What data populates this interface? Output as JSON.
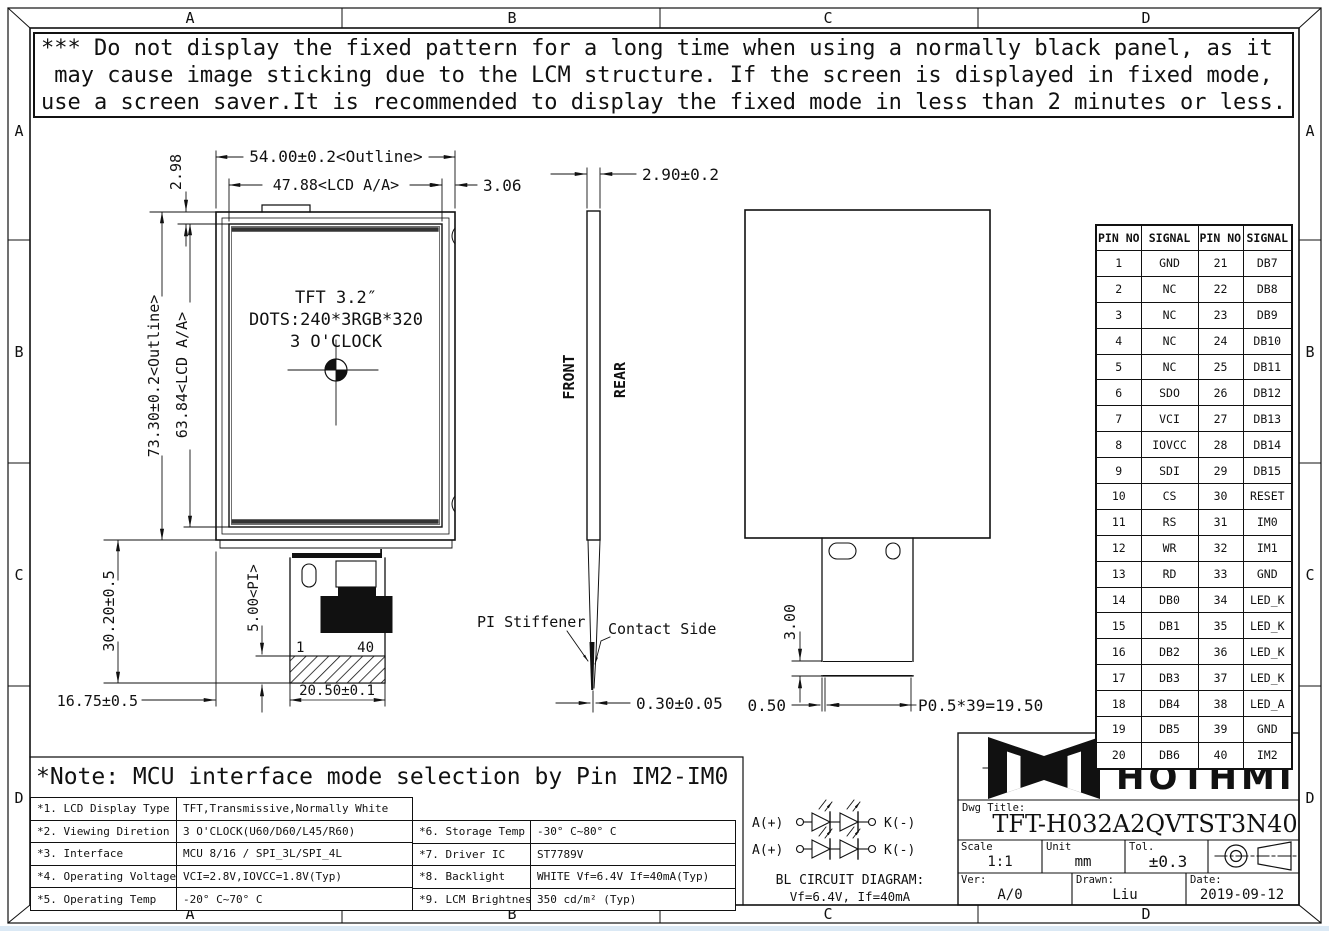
{
  "colors": {
    "line": "#111111",
    "paper": "#ffffff",
    "edge_strip": "#dbe9f5"
  },
  "sheet": {
    "zones": [
      "A",
      "B",
      "C",
      "D"
    ]
  },
  "warning": {
    "line1": "*** Do not display the fixed pattern for a long time when using a normally black panel, as it",
    "line2": "may cause image sticking due to the LCM structure. If the screen is displayed in fixed mode,",
    "line3": "use a screen saver.It is recommended to display the fixed mode in less than 2 minutes or less."
  },
  "front_view": {
    "center_line1": "TFT 3.2″",
    "center_line2": "DOTS:240*3RGB*320",
    "center_line3": "3 O'CLOCK",
    "dims": {
      "outline_w": "54.00±0.2<Outline>",
      "aa_w": "47.88<LCD A/A>",
      "border_r": "3.06",
      "border_t": "2.98",
      "outline_h": "73.30±0.2<Outline>",
      "aa_h": "63.84<LCD A/A>",
      "tail_h": "30.20±0.5",
      "pi_h": "5.00<PI>",
      "tail_offset": "16.75±0.5",
      "tail_w": "20.50±0.1",
      "pin_first": "1",
      "pin_last": "40"
    }
  },
  "side_view": {
    "front_label": "FRONT",
    "rear_label": "REAR",
    "thickness": "2.90±0.2",
    "pi_stiffener": "PI Stiffener",
    "contact_side": "Contact Side",
    "tip_thickness": "0.30±0.05"
  },
  "rear_view": {
    "pad_height": "3.00",
    "edge_gap": "0.50",
    "pitch": "P0.5*39=19.50"
  },
  "pin_table": {
    "h_pin": "PIN NO.",
    "h_signal": "SIGNAL",
    "rows": [
      [
        "1",
        "GND",
        "21",
        "DB7"
      ],
      [
        "2",
        "NC",
        "22",
        "DB8"
      ],
      [
        "3",
        "NC",
        "23",
        "DB9"
      ],
      [
        "4",
        "NC",
        "24",
        "DB10"
      ],
      [
        "5",
        "NC",
        "25",
        "DB11"
      ],
      [
        "6",
        "SDO",
        "26",
        "DB12"
      ],
      [
        "7",
        "VCI",
        "27",
        "DB13"
      ],
      [
        "8",
        "IOVCC",
        "28",
        "DB14"
      ],
      [
        "9",
        "SDI",
        "29",
        "DB15"
      ],
      [
        "10",
        "CS",
        "30",
        "RESET"
      ],
      [
        "11",
        "RS",
        "31",
        "IM0"
      ],
      [
        "12",
        "WR",
        "32",
        "IM1"
      ],
      [
        "13",
        "RD",
        "33",
        "GND"
      ],
      [
        "14",
        "DB0",
        "34",
        "LED_K"
      ],
      [
        "15",
        "DB1",
        "35",
        "LED_K"
      ],
      [
        "16",
        "DB2",
        "36",
        "LED_K"
      ],
      [
        "17",
        "DB3",
        "37",
        "LED_K"
      ],
      [
        "18",
        "DB4",
        "38",
        "LED_A"
      ],
      [
        "19",
        "DB5",
        "39",
        "GND"
      ],
      [
        "20",
        "DB6",
        "40",
        "IM2"
      ]
    ]
  },
  "note": {
    "text": "*Note: MCU interface mode selection by Pin IM2-IM0"
  },
  "spec_table_left": {
    "rows": [
      [
        "*1. LCD Display Type",
        "TFT,Transmissive,Normally White"
      ],
      [
        "*2. Viewing Diretion",
        "3 O'CLOCK(U60/D60/L45/R60)"
      ],
      [
        "*3. Interface",
        "MCU 8/16 / SPI_3L/SPI_4L"
      ],
      [
        "*4. Operating Voltage",
        "VCI=2.8V,IOVCC=1.8V(Typ)"
      ],
      [
        "*5. Operating Temp",
        "-20° C~70° C"
      ]
    ]
  },
  "spec_table_right": {
    "rows": [
      [
        "*6. Storage Temp",
        "-30° C~80° C"
      ],
      [
        "*7. Driver IC",
        "ST7789V"
      ],
      [
        "*8. Backlight",
        "WHITE Vf=6.4V If=40mA(Typ)"
      ],
      [
        "*9. LCM Brightness",
        "350 cd/m² (Typ)"
      ]
    ]
  },
  "bl_circuit": {
    "anode": "A(+)",
    "cathode": "K(-)",
    "caption1": "BL CIRCUIT DIAGRAM:",
    "caption2": "Vf=6.4V, If=40mA"
  },
  "title_block": {
    "brand": "HOTHMI",
    "dwg_title_label": "Dwg Title:",
    "dwg_title": "TFT-H032A2QVTST3N40",
    "scale_label": "Scale",
    "scale_value": "1:1",
    "unit_label": "Unit",
    "unit_value": "mm",
    "tol_label": "Tol.",
    "tol_value": "±0.3",
    "ver_label": "Ver:",
    "ver_value": "A/0",
    "drawn_label": "Drawn:",
    "drawn_value": "Liu",
    "date_label": "Date:",
    "date_value": "2019-09-12"
  }
}
